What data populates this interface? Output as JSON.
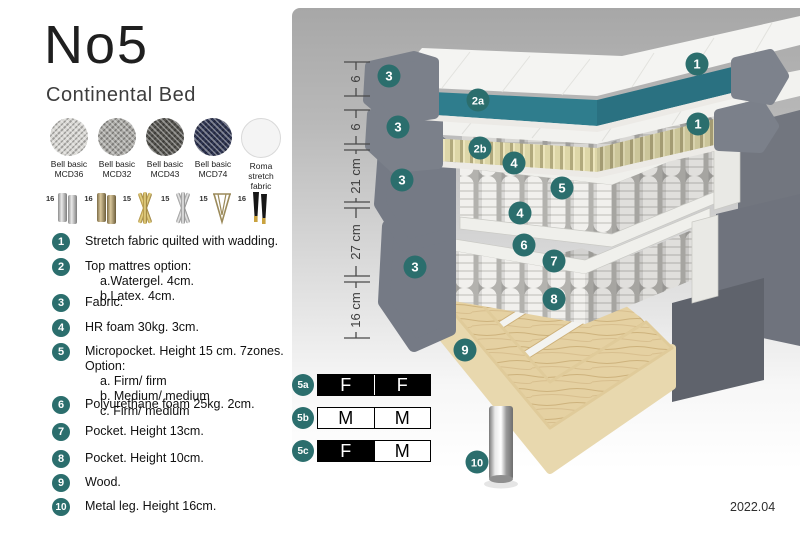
{
  "header": {
    "title": "No5",
    "subtitle": "Continental Bed"
  },
  "fabrics": [
    {
      "line1": "Bell basic",
      "line2": "MCD36",
      "color": "#d8d7d3",
      "type": "woven"
    },
    {
      "line1": "Bell basic",
      "line2": "MCD32",
      "color": "#a9a8a4",
      "type": "woven"
    },
    {
      "line1": "Bell basic",
      "line2": "MCD43",
      "color": "#565550",
      "type": "woven"
    },
    {
      "line1": "Bell basic",
      "line2": "MCD74",
      "color": "#2f3552",
      "type": "woven"
    },
    {
      "line1": "Roma",
      "line2": "stretch fabric",
      "color": "#f4f4f4",
      "type": "plain"
    }
  ],
  "leg_options": [
    {
      "size": "16",
      "icon": "leg-cylinder-silver-icon"
    },
    {
      "size": "16",
      "icon": "leg-cylinder-bronze-icon"
    },
    {
      "size": "15",
      "icon": "leg-twisted-gold-icon"
    },
    {
      "size": "15",
      "icon": "leg-twisted-silver-icon"
    },
    {
      "size": "15",
      "icon": "leg-hairpin-icon"
    },
    {
      "size": "16",
      "icon": "leg-tapered-black-gold-icon"
    }
  ],
  "spec_list": [
    {
      "num": "1",
      "lines": [
        "Stretch fabric quilted with wadding."
      ]
    },
    {
      "num": "2",
      "lines": [
        "Top mattres option:",
        "a.Watergel. 4cm.",
        "b.Latex. 4cm."
      ]
    },
    {
      "num": "3",
      "lines": [
        "Fabric."
      ]
    },
    {
      "num": "4",
      "lines": [
        "HR foam 30kg. 3cm."
      ]
    },
    {
      "num": "5",
      "lines": [
        "Micropocket. Height 15 cm. 7zones. Option:",
        "a. Firm/ firm",
        "b. Medium/ medium",
        "c. Firm/ medium"
      ]
    },
    {
      "num": "6",
      "lines": [
        "Polyurethane foam 25kg. 2cm."
      ]
    },
    {
      "num": "7",
      "lines": [
        "Pocket. Height 13cm."
      ]
    },
    {
      "num": "8",
      "lines": [
        "Pocket. Height 10cm."
      ]
    },
    {
      "num": "9",
      "lines": [
        "Wood."
      ]
    },
    {
      "num": "10",
      "lines": [
        "Metal leg. Height 16cm."
      ]
    }
  ],
  "diagram": {
    "dims": [
      {
        "label": "6"
      },
      {
        "label": "6"
      },
      {
        "label": "21 cm"
      },
      {
        "label": "27 cm"
      },
      {
        "label": "16 cm"
      }
    ],
    "badges": [
      "1",
      "2a",
      "3",
      "1",
      "2b",
      "3",
      "4",
      "5",
      "4",
      "3",
      "6",
      "7",
      "8",
      "3",
      "9",
      "10"
    ]
  },
  "firmness": [
    {
      "id": "5a",
      "cells": [
        {
          "text": "F",
          "style": "dark"
        },
        {
          "text": "F",
          "style": "dark"
        }
      ]
    },
    {
      "id": "5b",
      "cells": [
        {
          "text": "M",
          "style": "light"
        },
        {
          "text": "M",
          "style": "light"
        }
      ]
    },
    {
      "id": "5c",
      "cells": [
        {
          "text": "F",
          "style": "dark"
        },
        {
          "text": "M",
          "style": "light"
        }
      ]
    }
  ],
  "version": "2022.04",
  "colors": {
    "badge_teal": "#2b6e6d",
    "topper_teal": "#2f7d8d",
    "latex_tan": "#d9d2a6",
    "fabric_gray": "#757a85",
    "wood": "#e4cfa0",
    "firmness_dark": "#000000"
  }
}
